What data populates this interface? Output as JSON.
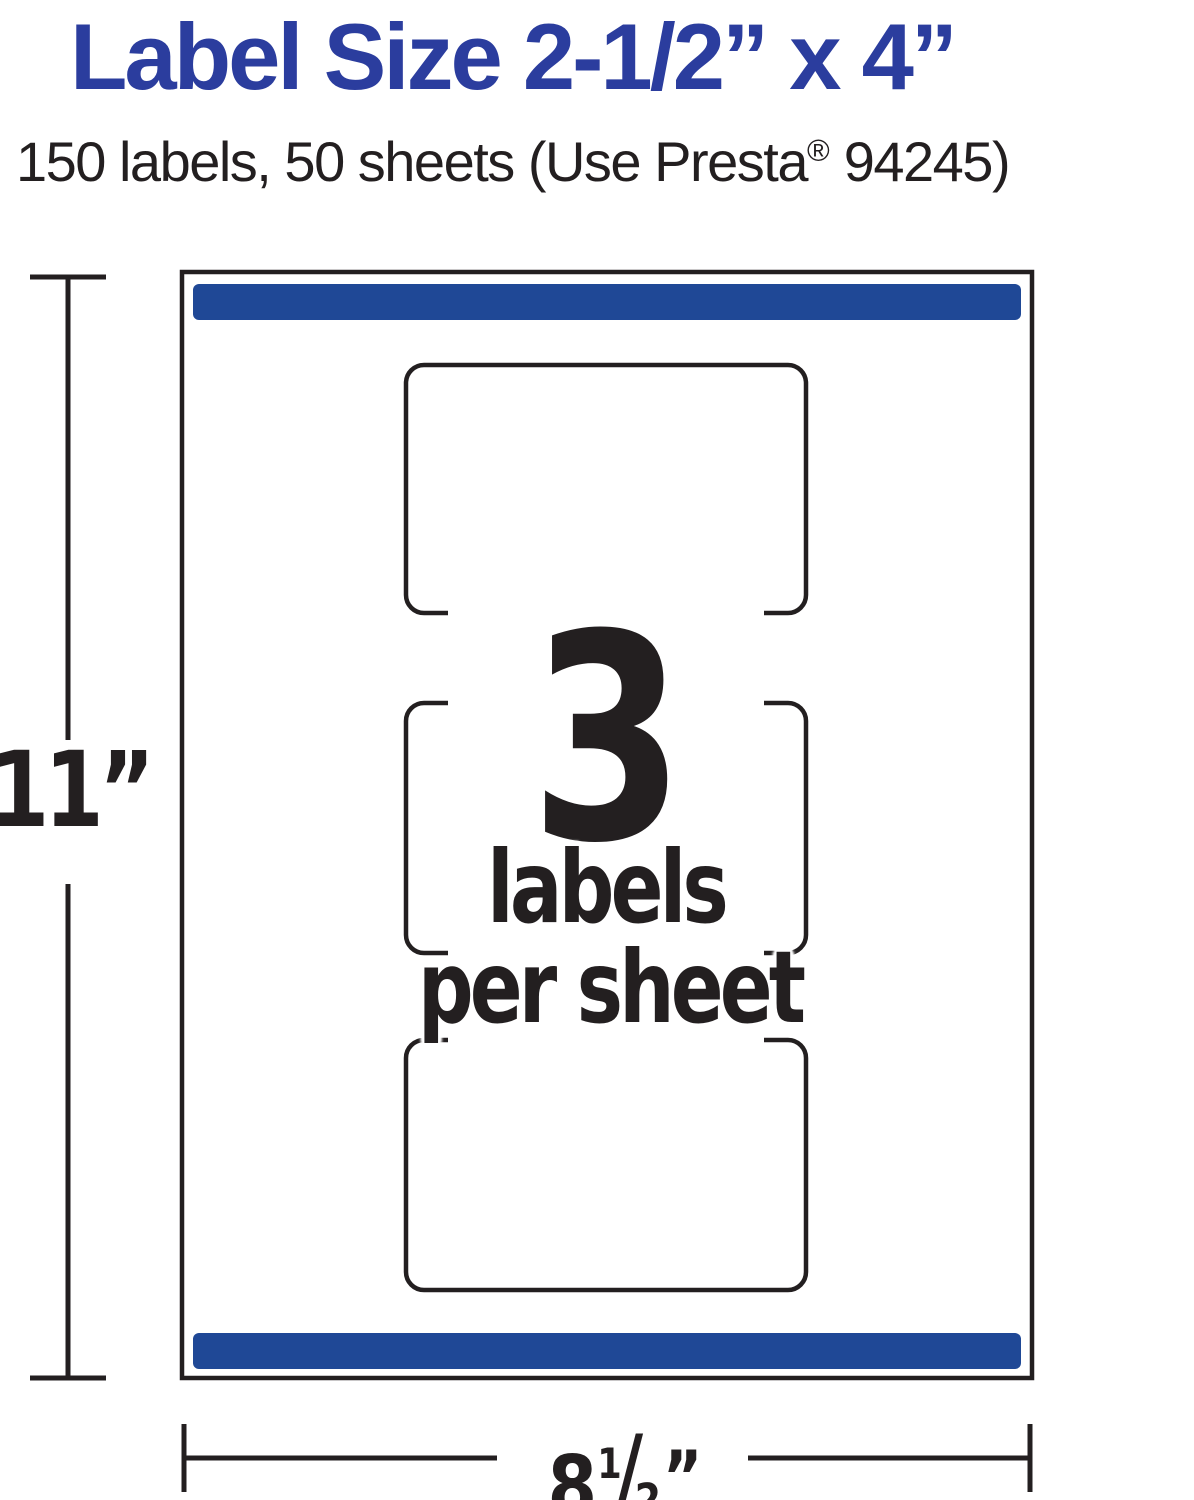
{
  "header": {
    "title": "Label Size 2-1/2” x 4”",
    "subtitle": {
      "part1": "150 labels, 50 sheets (Use Presta",
      "reg": "®",
      "part2": " 94245)"
    }
  },
  "center": {
    "count": "3",
    "line1": "labels",
    "line2": "per sheet"
  },
  "dimensions": {
    "height": "11”",
    "width_whole": "8",
    "width_numerator": "1",
    "width_slash": "/",
    "width_denominator": "2",
    "width_unit": "”"
  },
  "sheet": {
    "labels_per_sheet_shown": 3
  },
  "colors": {
    "title_blue": "#2B3D9E",
    "bar_blue": "#1F4896",
    "ink": "#231F20",
    "paper": "#ffffff"
  }
}
